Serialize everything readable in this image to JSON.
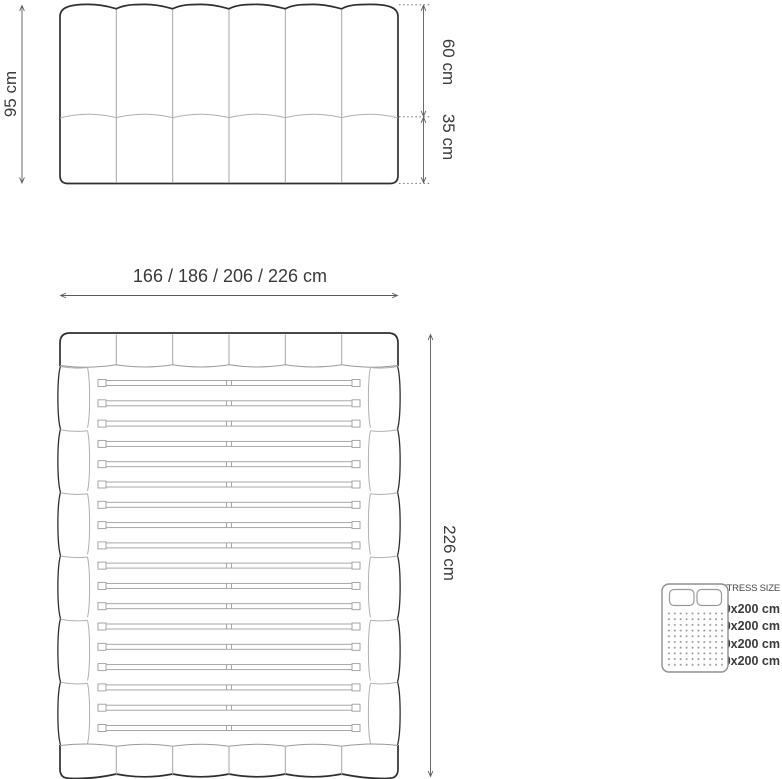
{
  "front_view": {
    "height_label": "95 cm",
    "upper_section_label": "60 cm",
    "lower_section_label": "35 cm"
  },
  "width_dimension": {
    "label": "166 / 186 / 206 / 226 cm"
  },
  "top_view": {
    "length_label": "226 cm"
  },
  "legend": {
    "title": "MATTRESS SIZE",
    "icon": "mattress-top-view-icon",
    "items": [
      {
        "bed_width": "166 cm:",
        "mattress_size": "140x200 cm"
      },
      {
        "bed_width": "186 cm:",
        "mattress_size": "160x200 cm"
      },
      {
        "bed_width": "206 cm:",
        "mattress_size": "180x200 cm"
      },
      {
        "bed_width": "226 cm:",
        "mattress_size": "200x200 cm"
      }
    ]
  },
  "colors": {
    "line_dark": "#2f2f2f",
    "line_light": "#a5a5a5",
    "dimension_line": "#5a5a5a",
    "text_dark": "#3a3a3a",
    "text_gray": "#9c9c9c"
  }
}
